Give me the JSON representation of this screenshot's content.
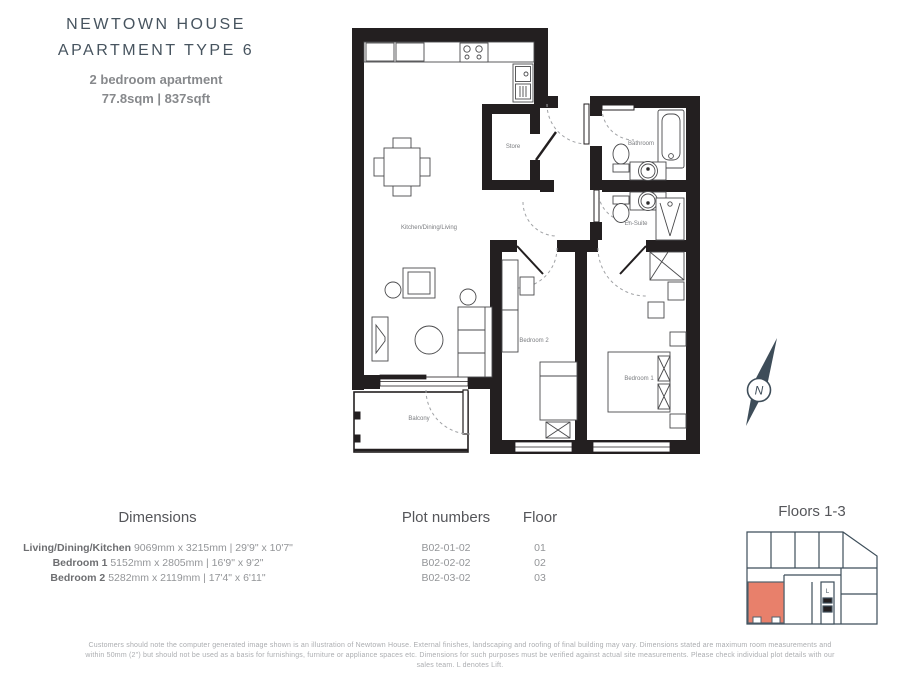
{
  "header": {
    "title_line1": "NEWTOWN HOUSE",
    "title_line2": "APARTMENT TYPE 6",
    "subtitle": "2 bedroom apartment",
    "area": "77.8sqm | 837sqft"
  },
  "floorplan": {
    "labels": {
      "kitchen": "Kitchen/Dining/Living",
      "store": "Store",
      "bathroom": "Bathroom",
      "ensuite": "En-Suite",
      "bedroom1": "Bedroom 1",
      "bedroom2": "Bedroom 2",
      "balcony": "Balcony"
    }
  },
  "compass": {
    "letter": "N"
  },
  "table": {
    "headers": {
      "dimensions": "Dimensions",
      "plots": "Plot numbers",
      "floor": "Floor"
    },
    "rows": [
      {
        "room": "Living/Dining/Kitchen",
        "dims": "9069mm x 3215mm | 29'9\" x 10'7\"",
        "plot": "B02-01-02",
        "floor": "01"
      },
      {
        "room": "Bedroom 1",
        "dims": "5152mm x 2805mm | 16'9\" x 9'2\"",
        "plot": "B02-02-02",
        "floor": "02"
      },
      {
        "room": "Bedroom 2",
        "dims": "5282mm x 2119mm | 17'4\" x 6'11\"",
        "plot": "B02-03-02",
        "floor": "03"
      }
    ]
  },
  "keyplan": {
    "title": "Floors 1-3",
    "lift_label": "L",
    "highlight_color": "#e8806b"
  },
  "disclaimer": "Customers should note the computer generated image shown is an illustration of Newtown House. External finishes, landscaping and roofing of final building may vary. Dimensions stated are maximum room measurements and within 50mm (2\") but should not be used as a basis for furnishings, furniture or appliance spaces etc. Dimensions for such purposes must be verified against actual site measurements. Please check individual plot details with our sales team. L denotes Lift.",
  "colors": {
    "wall": "#231f20",
    "title": "#47545f",
    "highlight": "#e8806b",
    "keyplan_line": "#3d4e5a"
  }
}
